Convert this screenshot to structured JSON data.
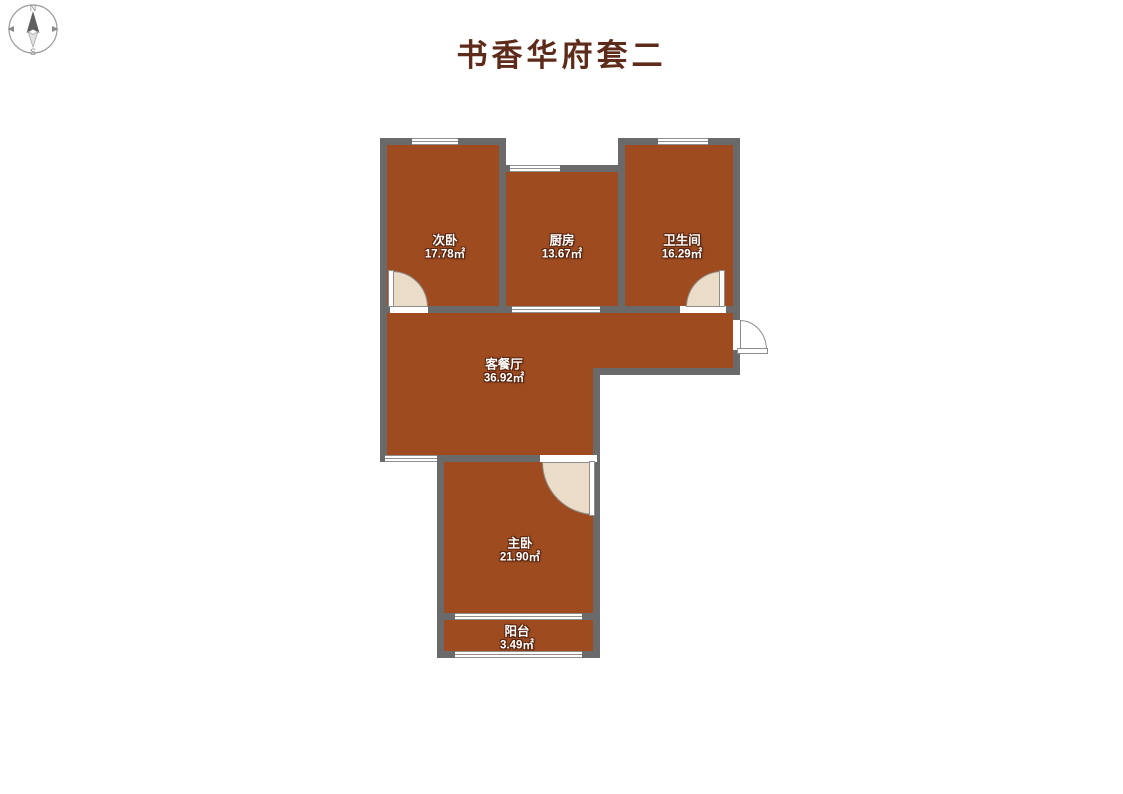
{
  "title": "书香华府套二",
  "compass": {
    "north": "N",
    "south": "S"
  },
  "rooms": [
    {
      "id": "secondary-bedroom",
      "name": "次卧",
      "area": "17.78㎡"
    },
    {
      "id": "kitchen",
      "name": "厨房",
      "area": "13.67㎡"
    },
    {
      "id": "bathroom",
      "name": "卫生间",
      "area": "16.29㎡"
    },
    {
      "id": "living-dining",
      "name": "客餐厅",
      "area": "36.92㎡"
    },
    {
      "id": "master-bedroom",
      "name": "主卧",
      "area": "21.90㎡"
    },
    {
      "id": "balcony",
      "name": "阳台",
      "area": "3.49㎡"
    }
  ],
  "colors": {
    "wall": "#6a6a6a",
    "room_fill": "#9e4b20",
    "title": "#5e2b1b",
    "window_line": "#8f8f8f",
    "door_swing": "#eadcc6",
    "label_text": "#ffffff",
    "label_shadow": "#59250e"
  }
}
